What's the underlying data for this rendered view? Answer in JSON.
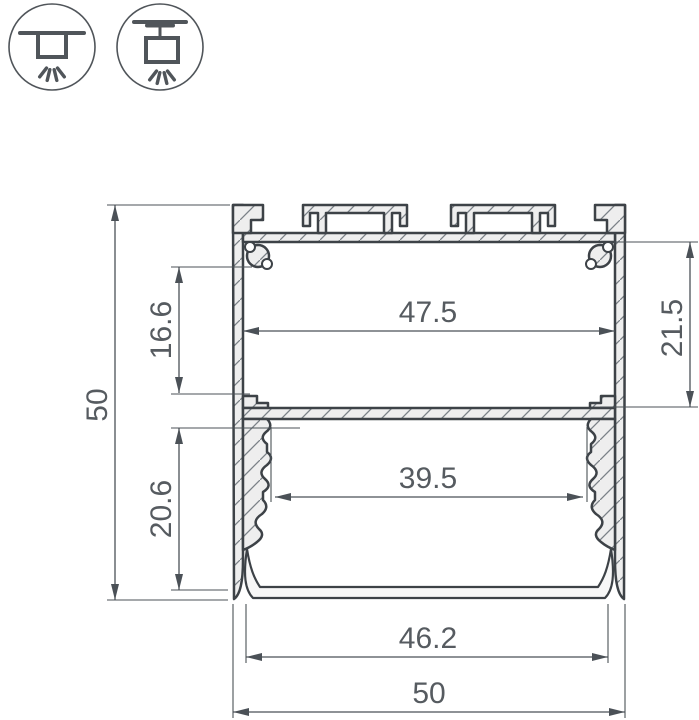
{
  "drawing": {
    "type": "profile-cross-section-drawing",
    "colors": {
      "background": "#ffffff",
      "outline": "#3d4247",
      "metal_fill": "#eeeeee",
      "dimension_lines": "#4b5157",
      "dimension_text": "#565b60"
    },
    "icons": [
      {
        "name": "surface-mount-icon"
      },
      {
        "name": "pendant-mount-icon"
      }
    ],
    "dims": {
      "overall_height": "50",
      "upper_chamber_height": "16.6",
      "upper_chamber_width": "47.5",
      "right_section_height": "21.5",
      "lower_chamber_height": "20.6",
      "lower_chamber_width": "39.5",
      "diffuser_width": "46.2",
      "overall_width": "50"
    }
  }
}
